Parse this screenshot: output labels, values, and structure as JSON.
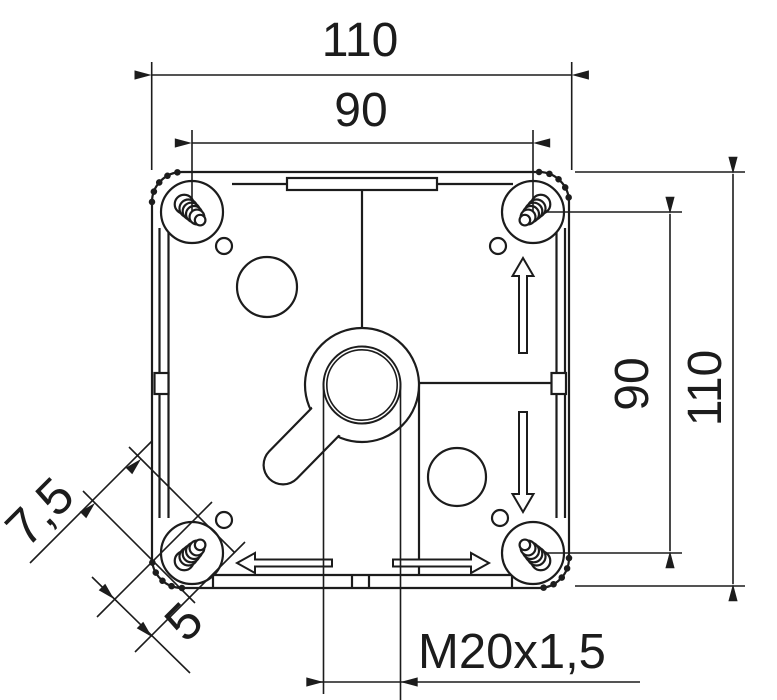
{
  "colors": {
    "ink": "#1c1c1c",
    "paper": "#ffffff"
  },
  "dimensions": {
    "width_overall": "110",
    "width_mounting": "90",
    "height_mounting": "90",
    "height_overall": "110",
    "corner_offset_diagonal": "7,5",
    "corner_offset_inner": "5",
    "gland_thread": "M20x1,5"
  }
}
